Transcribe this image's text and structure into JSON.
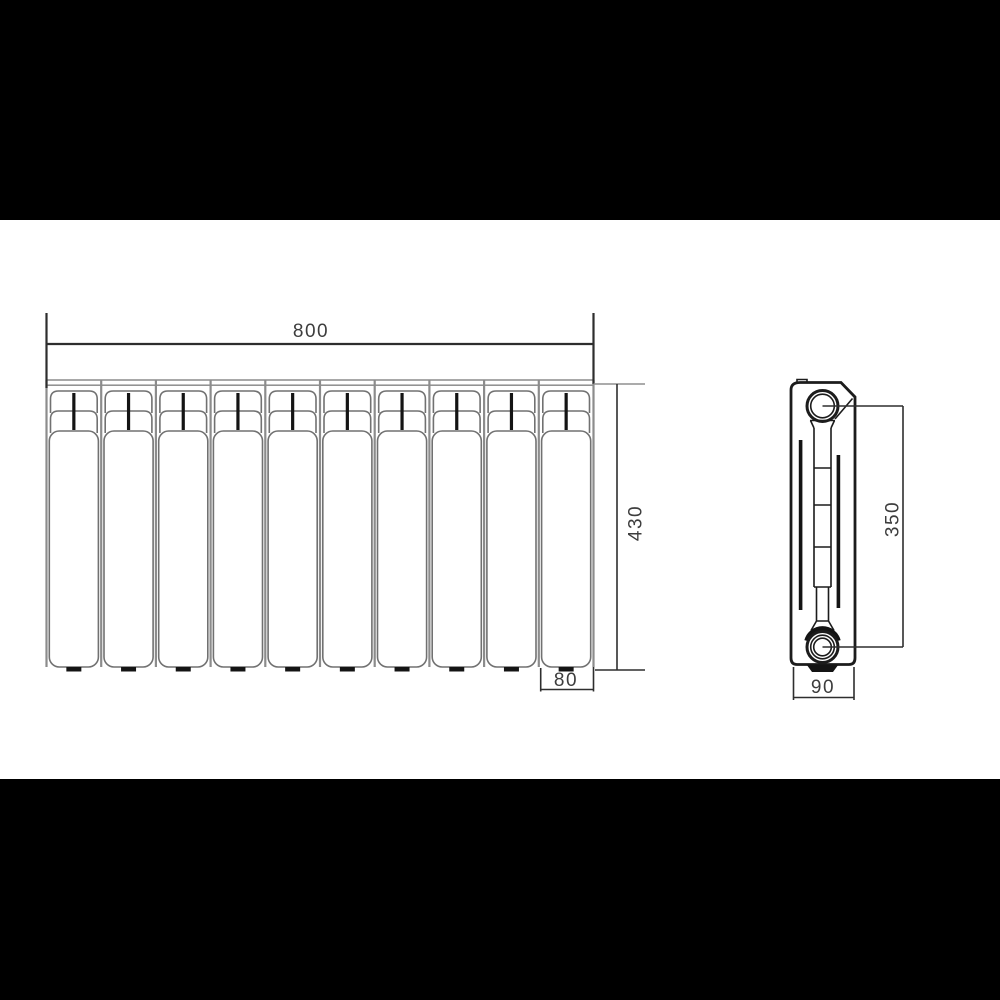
{
  "meta": {
    "description": "Technical dimension drawing of a sectional radiator: front view with 10 sections and side profile view",
    "background_color": "#000000",
    "paper_color": "#ffffff"
  },
  "drawing": {
    "front_view": {
      "name": "radiator-front-view",
      "section_count": 10
    },
    "side_view": {
      "name": "radiator-side-view"
    },
    "dimensions": {
      "overall_width": "800",
      "overall_height": "430",
      "section_width": "80",
      "port_axis_height": "350",
      "depth": "90"
    },
    "colors": {
      "dim_line": "#2e2e2e",
      "section_outline": "#717171",
      "boundary_gray": "#8c8c8c",
      "detail_black": "#141414",
      "side_outline": "#1c1c1c",
      "text": "#3d3d3d"
    }
  }
}
